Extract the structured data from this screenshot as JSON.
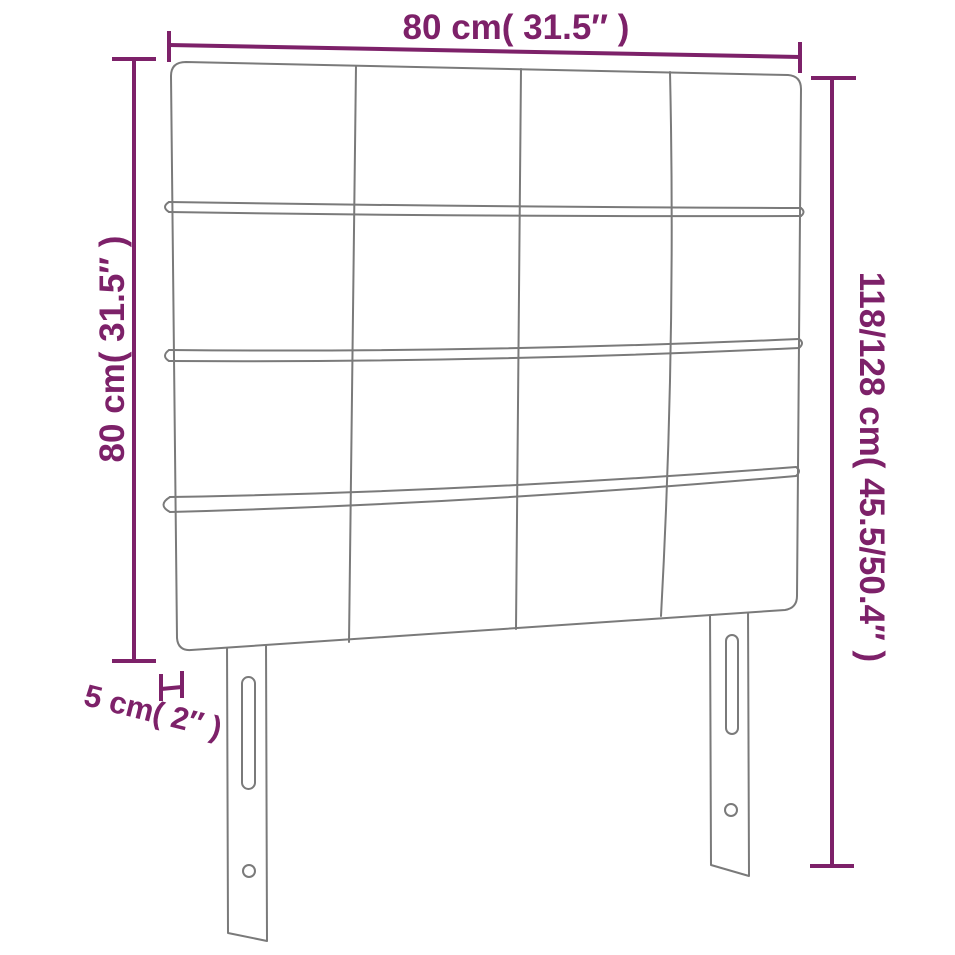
{
  "diagram": {
    "colors": {
      "dimension": "#7d2169",
      "outline": "#7a7a7a",
      "background": "#ffffff"
    },
    "labels": {
      "width_top": "80 cm( 31.5″ )",
      "height_left": "80 cm( 31.5″ )",
      "height_right": "118/128 cm( 45.5/50.4″ )",
      "thickness": "5 cm( 2″ )"
    }
  }
}
